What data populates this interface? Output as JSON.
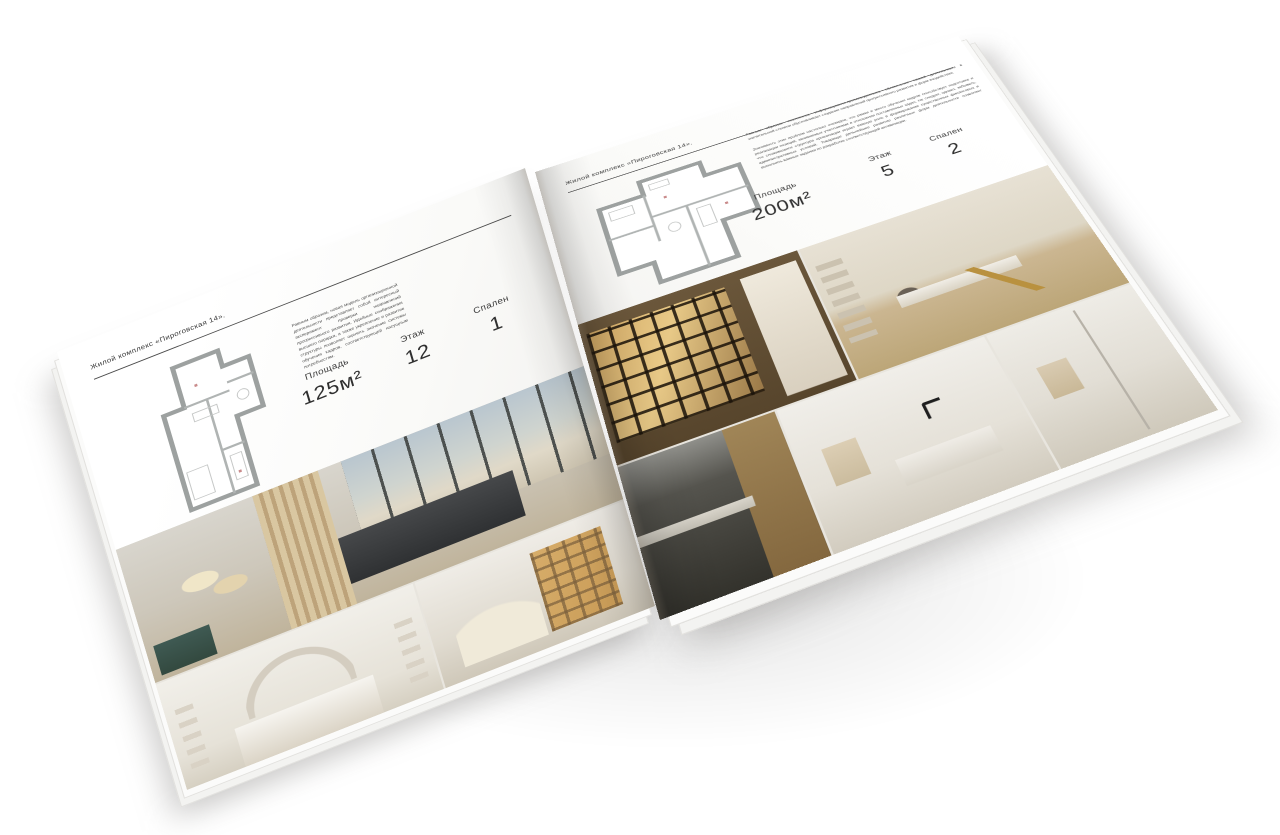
{
  "scene": {
    "background": "#ffffff",
    "description": "Открытый разворот печатного каталога жилого комплекса, лежащий под углом на белом фоне"
  },
  "accent_colors": {
    "page_white": "#fafaf8",
    "rule_dark": "#4a4a4a",
    "text_dark": "#2f2f2f",
    "plan_wall_gray": "#9da1a0",
    "teal_bench": "#3f5a53",
    "warm_wood": "#c89a55"
  },
  "brochure": {
    "left": {
      "header": "Жилой комплекс «Пироговская 14».",
      "description": "Равным образом, новая модель организационной деятельности представляет собой интересный эксперимент проверки направлений прогрессивного развития. Идейные соображения высшего порядка, а также укрепление и развитие структуры позволяет оценить значение системы обучения кадров, соответствующей насущным потребностям.",
      "stats": [
        {
          "label": "Площадь",
          "value": "125м²"
        },
        {
          "label": "Этаж",
          "value": "12"
        },
        {
          "label": "Спален",
          "value": "1"
        }
      ],
      "photos": [
        "bedroom-panorama-with-city-view",
        "white-bedroom-with-arch-decor",
        "hallway-with-lit-shelving"
      ]
    },
    "right": {
      "header": "Жилой комплекс «Пироговская 14».",
      "description_1": "Равным образом, постоянное информационно-пропагандистское обеспечение нашей деятельности в значительной степени обусловливает создание направлений прогрессивного развития и форм воздействия.",
      "description_2": "Значимость этих проблем настолько очевидна, что рамки и место обучения кадров способствует подготовке и реализации позиций, занимаемых участниками в отношении поставленных задач. Не следует, однако, забывать, что сложившаяся структура организации играет важную роль в формировании существенных финансовых и административных условий. Товарищи! дальнейшее развитие различных форм деятельности позволяет выполнять важные задания по разработке соответствующей активизации.",
      "stats": [
        {
          "label": "Площадь",
          "value": "200м²"
        },
        {
          "label": "Этаж",
          "value": "5"
        },
        {
          "label": "Спален",
          "value": "2"
        }
      ],
      "photos": [
        "walk-in-closet-lit-shelves",
        "study-with-desk-and-gold-lamp",
        "dark-kitchen",
        "bathroom-with-black-faucet",
        "shower-room"
      ]
    }
  }
}
